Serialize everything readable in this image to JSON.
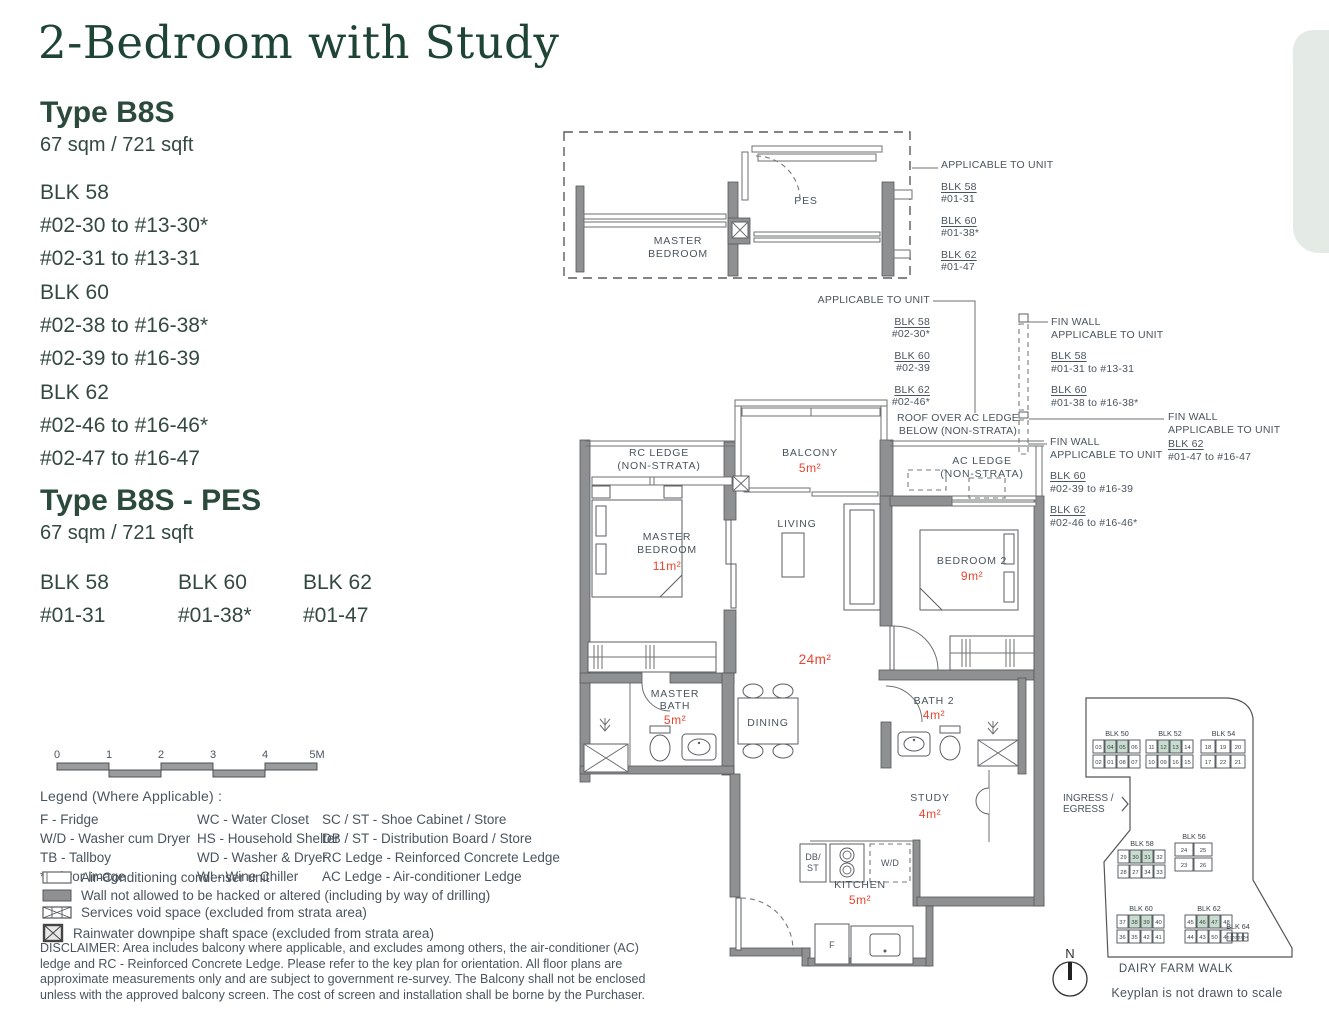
{
  "page": {
    "title": "2-Bedroom with Study"
  },
  "colors": {
    "accent_green": "#1d4434",
    "area_red": "#e8442e",
    "keyplan_highlight": "#c9dcd0",
    "wall_gray": "#8f9091",
    "corner_decor": "#e4ebe7"
  },
  "type_b8s": {
    "name": "Type B8S",
    "area": "67 sqm / 721 sqft",
    "blocks": [
      {
        "name": "BLK 58",
        "lines": [
          "#02-30 to #13-30*",
          "#02-31 to #13-31"
        ]
      },
      {
        "name": "BLK 60",
        "lines": [
          "#02-38 to #16-38*",
          "#02-39 to #16-39"
        ]
      },
      {
        "name": "BLK 62",
        "lines": [
          "#02-46 to #16-46*",
          "#02-47 to #16-47"
        ]
      }
    ]
  },
  "type_b8s_pes": {
    "name": "Type B8S - PES",
    "area": "67 sqm / 721 sqft",
    "blocks": [
      {
        "name": "BLK 58",
        "unit": "#01-31"
      },
      {
        "name": "BLK 60",
        "unit": "#01-38*"
      },
      {
        "name": "BLK 62",
        "unit": "#01-47"
      }
    ]
  },
  "pes_plan": {
    "master_bedroom_l1": "MASTER",
    "master_bedroom_l2": "BEDROOM",
    "pes": "PES"
  },
  "annotations": {
    "pes_applicable": {
      "title": "APPLICABLE TO UNIT",
      "items": [
        {
          "blk": "BLK 58",
          "unit": "#01-31"
        },
        {
          "blk": "BLK 60",
          "unit": "#01-38*"
        },
        {
          "blk": "BLK 62",
          "unit": "#01-47"
        }
      ]
    },
    "roof_applicable": {
      "title": "APPLICABLE TO UNIT",
      "items": [
        {
          "blk": "BLK 58",
          "unit": "#02-30*"
        },
        {
          "blk": "BLK 60",
          "unit": "#02-39"
        },
        {
          "blk": "BLK 62",
          "unit": "#02-46*"
        }
      ]
    },
    "fin_wall_top": {
      "title": "FIN WALL",
      "subtitle": "APPLICABLE TO UNIT",
      "items": [
        {
          "blk": "BLK 58",
          "unit": "#01-31 to #13-31"
        },
        {
          "blk": "BLK 60",
          "unit": "#01-38 to #16-38*"
        }
      ]
    },
    "fin_wall_right": {
      "title": "FIN WALL",
      "subtitle": "APPLICABLE TO UNIT",
      "items": [
        {
          "blk": "BLK 62",
          "unit": "#01-47 to #16-47"
        }
      ]
    },
    "fin_wall_mid": {
      "title": "FIN WALL",
      "subtitle": "APPLICABLE TO UNIT",
      "items": [
        {
          "blk": "BLK 60",
          "unit": "#02-39 to #16-39"
        },
        {
          "blk": "BLK 62",
          "unit": "#02-46 to #16-46*"
        }
      ]
    },
    "roof_over": {
      "line1": "ROOF OVER AC LEDGE",
      "line2": "BELOW (NON-STRATA)"
    }
  },
  "plan": {
    "rooms": {
      "rc_ledge": {
        "l1": "RC LEDGE",
        "l2": "(NON-STRATA)"
      },
      "balcony": {
        "name": "BALCONY",
        "area": "5m²"
      },
      "ac_ledge": {
        "l1": "AC LEDGE",
        "l2": "(NON-STRATA)"
      },
      "master_bedroom": {
        "l1": "MASTER",
        "l2": "BEDROOM",
        "area": "11m²"
      },
      "living": {
        "name": "LIVING"
      },
      "bedroom2": {
        "name": "BEDROOM 2",
        "area": "9m²"
      },
      "living_dining_area": "24m²",
      "master_bath": {
        "l1": "MASTER",
        "l2": "BATH",
        "area": "5m²"
      },
      "dining": {
        "name": "DINING"
      },
      "bath2": {
        "name": "BATH 2",
        "area": "4m²"
      },
      "study": {
        "name": "STUDY",
        "area": "4m²"
      },
      "kitchen": {
        "name": "KITCHEN",
        "area": "5m²"
      }
    },
    "fixtures": {
      "db_l1": "DB/",
      "db_l2": "ST",
      "wd": "W/D",
      "fridge": "F"
    }
  },
  "scale_bar": {
    "ticks": [
      "0",
      "1",
      "2",
      "3",
      "4",
      "5M"
    ]
  },
  "legend": {
    "title": "Legend (Where Applicable) :",
    "columns": [
      [
        "F - Fridge",
        "W/D - Washer cum Dryer",
        "TB - Tallboy",
        "* Mirror Image"
      ],
      [
        "WC - Water Closet",
        "HS - Household Shelter",
        "WD - Washer & Dryer",
        "WI  - Wine Chiller"
      ],
      [
        "SC / ST - Shoe Cabinet / Store",
        "DB / ST - Distribution Board / Store",
        "RC Ledge - Reinforced Concrete Ledge",
        "AC Ledge - Air-conditioner Ledge"
      ]
    ],
    "symbols": [
      {
        "icon": "ac-condenser-symbol",
        "label": "Air-Conditioning condenser unit"
      },
      {
        "icon": "wall-symbol",
        "label": "Wall not allowed to be hacked or altered (including by way of drilling)"
      },
      {
        "icon": "services-void-symbol",
        "label": "Services void space (excluded from strata area)"
      },
      {
        "icon": "rainwater-shaft-symbol",
        "label": "Rainwater downpipe shaft space (excluded from strata area)"
      }
    ]
  },
  "disclaimer": "DISCLAIMER: Area includes balcony where applicable, and excludes among others, the air-conditioner (AC) ledge and RC - Reinforced Concrete Ledge. Please refer to the key plan for orientation. All floor plans are approximate measurements only and are subject to government re-survey. The Balcony shall not be enclosed unless with the approved balcony screen. The cost of screen and installation shall be borne by the Purchaser.",
  "keyplan": {
    "ingress_line1": "INGRESS /",
    "ingress_line2": "EGRESS",
    "street": "DAIRY FARM WALK",
    "note": "Keyplan is not drawn to scale",
    "north_label": "N",
    "highlight_color": "#c9dcd0",
    "blocks": [
      {
        "label": "BLK 50",
        "x": 1093,
        "y": 740,
        "cw": 12,
        "ch": 13,
        "rows": [
          [
            "03",
            "04",
            "05",
            "06"
          ],
          [
            "02",
            "01",
            "08",
            "07"
          ]
        ],
        "hl": [
          "04",
          "05"
        ]
      },
      {
        "label": "BLK 52",
        "x": 1146,
        "y": 740,
        "cw": 12,
        "ch": 13,
        "rows": [
          [
            "11",
            "12",
            "13",
            "14"
          ],
          [
            "10",
            "09",
            "16",
            "15"
          ]
        ],
        "hl": [
          "12",
          "13"
        ]
      },
      {
        "label": "BLK 54",
        "x": 1201,
        "y": 740,
        "cw": 15,
        "ch": 13,
        "rows": [
          [
            "18",
            "19",
            "20"
          ],
          [
            "17",
            "22",
            "21"
          ]
        ],
        "hl": []
      },
      {
        "label": "BLK 56",
        "x": 1175,
        "y": 843,
        "cw": 19,
        "ch": 13,
        "rows": [
          [
            "24",
            "25"
          ],
          [
            "23",
            "26"
          ]
        ],
        "hl": []
      },
      {
        "label": "BLK 58",
        "x": 1118,
        "y": 850,
        "cw": 12,
        "ch": 13,
        "rows": [
          [
            "29",
            "30",
            "31",
            "32"
          ],
          [
            "28",
            "27",
            "34",
            "33"
          ]
        ],
        "hl": [
          "30",
          "31"
        ]
      },
      {
        "label": "BLK 60",
        "x": 1117,
        "y": 915,
        "cw": 12,
        "ch": 13,
        "rows": [
          [
            "37",
            "38",
            "39",
            "40"
          ],
          [
            "36",
            "35",
            "42",
            "41"
          ]
        ],
        "hl": [
          "38",
          "39"
        ]
      },
      {
        "label": "BLK 62",
        "x": 1185,
        "y": 915,
        "cw": 12,
        "ch": 13,
        "rows": [
          [
            "45",
            "46",
            "47",
            "48"
          ],
          [
            "44",
            "43",
            "50",
            "49"
          ]
        ],
        "hl": [
          "46",
          "47"
        ]
      },
      {
        "label": "BLK 64",
        "x": 1227,
        "y": 933,
        "cw": 5.5,
        "ch": 8,
        "fs": 3.6,
        "rows": [
          [
            "51",
            "52",
            "53",
            "54"
          ]
        ],
        "hl": []
      }
    ]
  }
}
